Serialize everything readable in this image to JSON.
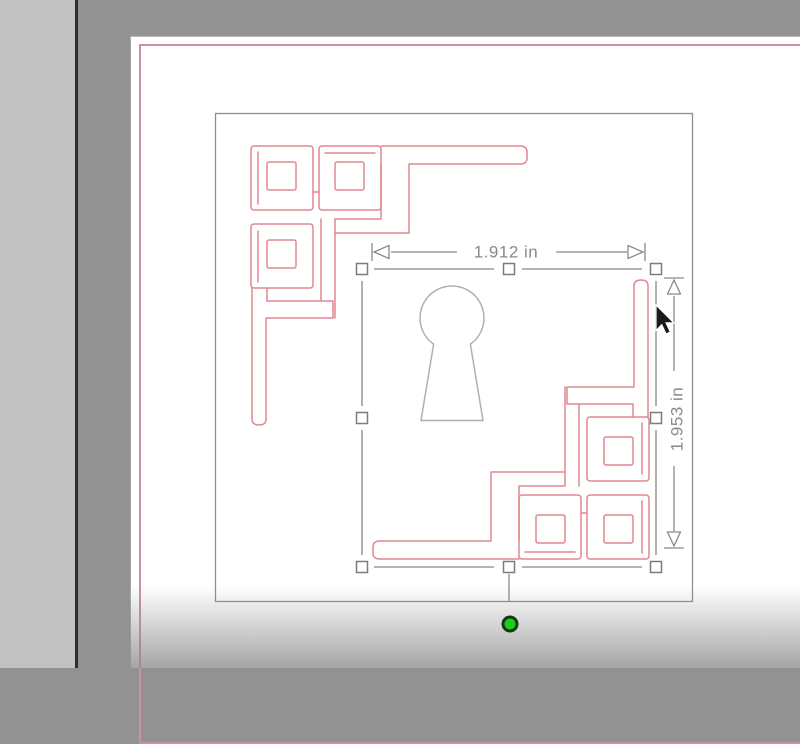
{
  "workspace": {
    "background_color": "#929292",
    "left_panel_color": "#c2c2c2",
    "divider_color": "#2d2d2d"
  },
  "page": {
    "color": "#ffffff",
    "margin_line_color": "#c9929e"
  },
  "design": {
    "bounding_stroke": "#8f8f8f",
    "flourish_color": "#e08790",
    "keyhole_color": "#b0b0b0",
    "elements": [
      "corner-flourish-top-left",
      "keyhole",
      "corner-flourish-bottom-right"
    ]
  },
  "selection": {
    "stroke_color": "#868686",
    "handle_fill": "#ffffff",
    "width_label": "1.912 in",
    "height_label": "1.953 in",
    "label_color": "#8a8a8a",
    "rotation_handle": {
      "fill": "#1ecb1e",
      "stroke": "#123c10"
    }
  },
  "cursor": {
    "icon": "arrow-pointer-icon",
    "color": "#1a1a1a"
  }
}
